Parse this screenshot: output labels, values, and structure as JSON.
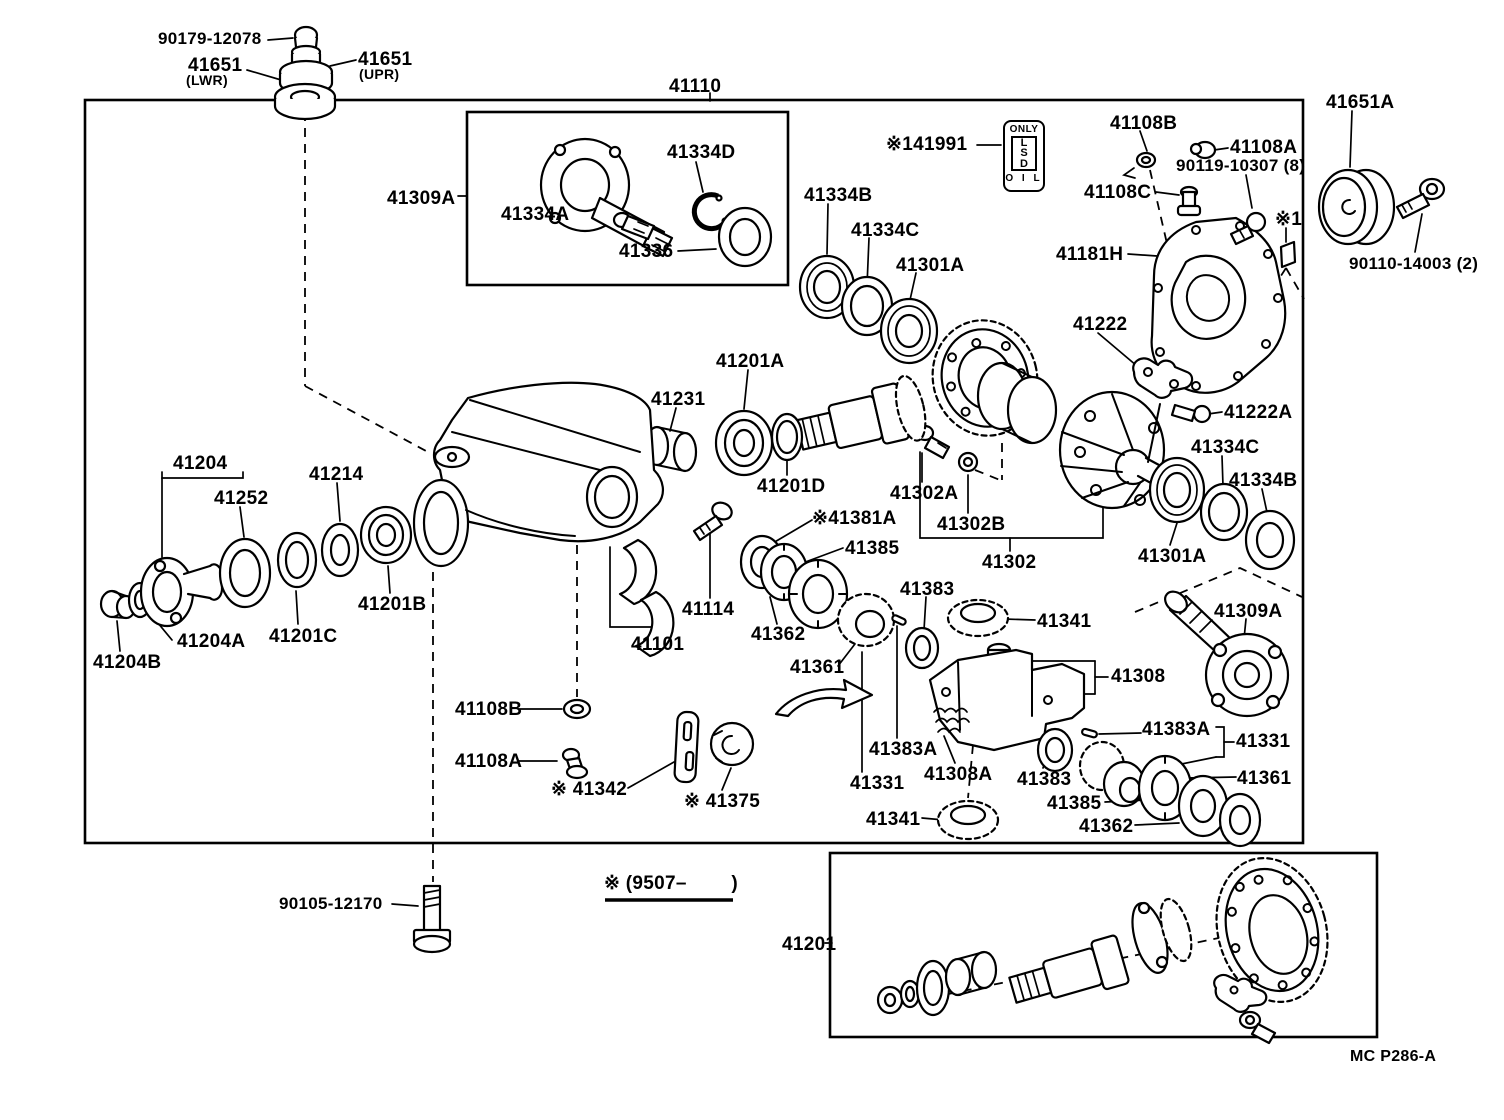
{
  "doc": {
    "type": "parts-catalog-exploded-diagram",
    "footer_code": "MC P286-A",
    "production_note": "※ (9507–        )",
    "ink_color": "#000000",
    "paper_color": "#ffffff"
  },
  "lsd_tag": {
    "only": "ONLY",
    "l1": "L",
    "l2": "S",
    "l3": "D",
    "oil": "O I L"
  },
  "diagram": {
    "labels": [
      {
        "text": "90179-12078",
        "x": 158,
        "y": 30,
        "fs": 17
      },
      {
        "text": "41651",
        "x": 188,
        "y": 56
      },
      {
        "text": "(LWR)",
        "x": 186,
        "y": 73,
        "fs": 14
      },
      {
        "text": "41651",
        "x": 358,
        "y": 50
      },
      {
        "text": "(UPR)",
        "x": 359,
        "y": 67,
        "fs": 14
      },
      {
        "text": "41110",
        "x": 669,
        "y": 77
      },
      {
        "text": "41309A",
        "x": 387,
        "y": 189
      },
      {
        "text": "41334D",
        "x": 667,
        "y": 143
      },
      {
        "text": "41334A",
        "x": 501,
        "y": 205
      },
      {
        "text": "41336",
        "x": 619,
        "y": 242
      },
      {
        "text": "41334B",
        "x": 804,
        "y": 186
      },
      {
        "text": "41334C",
        "x": 851,
        "y": 221
      },
      {
        "text": "41301A",
        "x": 896,
        "y": 256
      },
      {
        "text": "※141991",
        "x": 886,
        "y": 135
      },
      {
        "text": "41108B",
        "x": 1110,
        "y": 114
      },
      {
        "text": "41108A",
        "x": 1230,
        "y": 138
      },
      {
        "text": "90119-10307 (8)",
        "x": 1176,
        "y": 157,
        "fs": 17
      },
      {
        "text": "41108C",
        "x": 1084,
        "y": 183
      },
      {
        "text": "41181H",
        "x": 1056,
        "y": 245
      },
      {
        "text": "※1",
        "x": 1275,
        "y": 210
      },
      {
        "text": "41651A",
        "x": 1326,
        "y": 93
      },
      {
        "text": "90110-14003 (2)",
        "x": 1349,
        "y": 255,
        "fs": 17
      },
      {
        "text": "41222",
        "x": 1073,
        "y": 315
      },
      {
        "text": "41222A",
        "x": 1224,
        "y": 403
      },
      {
        "text": "41334C",
        "x": 1191,
        "y": 438
      },
      {
        "text": "41334B",
        "x": 1229,
        "y": 471
      },
      {
        "text": "41301A",
        "x": 1138,
        "y": 547
      },
      {
        "text": "41302",
        "x": 982,
        "y": 553
      },
      {
        "text": "41302A",
        "x": 890,
        "y": 484
      },
      {
        "text": "41302B",
        "x": 937,
        "y": 515
      },
      {
        "text": "41201A",
        "x": 716,
        "y": 352
      },
      {
        "text": "41231",
        "x": 651,
        "y": 390
      },
      {
        "text": "41201D",
        "x": 757,
        "y": 477
      },
      {
        "text": "※41381A",
        "x": 812,
        "y": 509
      },
      {
        "text": "41385",
        "x": 845,
        "y": 539
      },
      {
        "text": "41362",
        "x": 751,
        "y": 625
      },
      {
        "text": "41361",
        "x": 790,
        "y": 658
      },
      {
        "text": "41114",
        "x": 682,
        "y": 600
      },
      {
        "text": "41101",
        "x": 631,
        "y": 635
      },
      {
        "text": "41204",
        "x": 173,
        "y": 454
      },
      {
        "text": "41252",
        "x": 214,
        "y": 489
      },
      {
        "text": "41214",
        "x": 309,
        "y": 465
      },
      {
        "text": "41201B",
        "x": 358,
        "y": 595
      },
      {
        "text": "41201C",
        "x": 269,
        "y": 627
      },
      {
        "text": "41204A",
        "x": 177,
        "y": 632
      },
      {
        "text": "41204B",
        "x": 93,
        "y": 653
      },
      {
        "text": "41108B",
        "x": 455,
        "y": 700
      },
      {
        "text": "41108A",
        "x": 455,
        "y": 752
      },
      {
        "text": "※ 41342",
        "x": 551,
        "y": 780
      },
      {
        "text": "※ 41375",
        "x": 684,
        "y": 792
      },
      {
        "text": "90105-12170",
        "x": 279,
        "y": 895,
        "fs": 17
      },
      {
        "text": "※ (9507–        )",
        "x": 604,
        "y": 874
      },
      {
        "text": "41383",
        "x": 900,
        "y": 580
      },
      {
        "text": "41341",
        "x": 1037,
        "y": 612
      },
      {
        "text": "41308",
        "x": 1111,
        "y": 667
      },
      {
        "text": "41383A",
        "x": 869,
        "y": 740
      },
      {
        "text": "41331",
        "x": 850,
        "y": 774
      },
      {
        "text": "41308A",
        "x": 924,
        "y": 765
      },
      {
        "text": "41383",
        "x": 1017,
        "y": 770
      },
      {
        "text": "41341",
        "x": 866,
        "y": 810
      },
      {
        "text": "41385",
        "x": 1047,
        "y": 794
      },
      {
        "text": "41362",
        "x": 1079,
        "y": 817
      },
      {
        "text": "41383A",
        "x": 1142,
        "y": 720
      },
      {
        "text": "41331",
        "x": 1236,
        "y": 732
      },
      {
        "text": "41361",
        "x": 1237,
        "y": 769
      },
      {
        "text": "41309A",
        "x": 1214,
        "y": 602
      },
      {
        "text": "41201",
        "x": 782,
        "y": 935
      },
      {
        "text": "MC P286-A",
        "x": 1350,
        "y": 1049,
        "fs": 16
      }
    ]
  }
}
